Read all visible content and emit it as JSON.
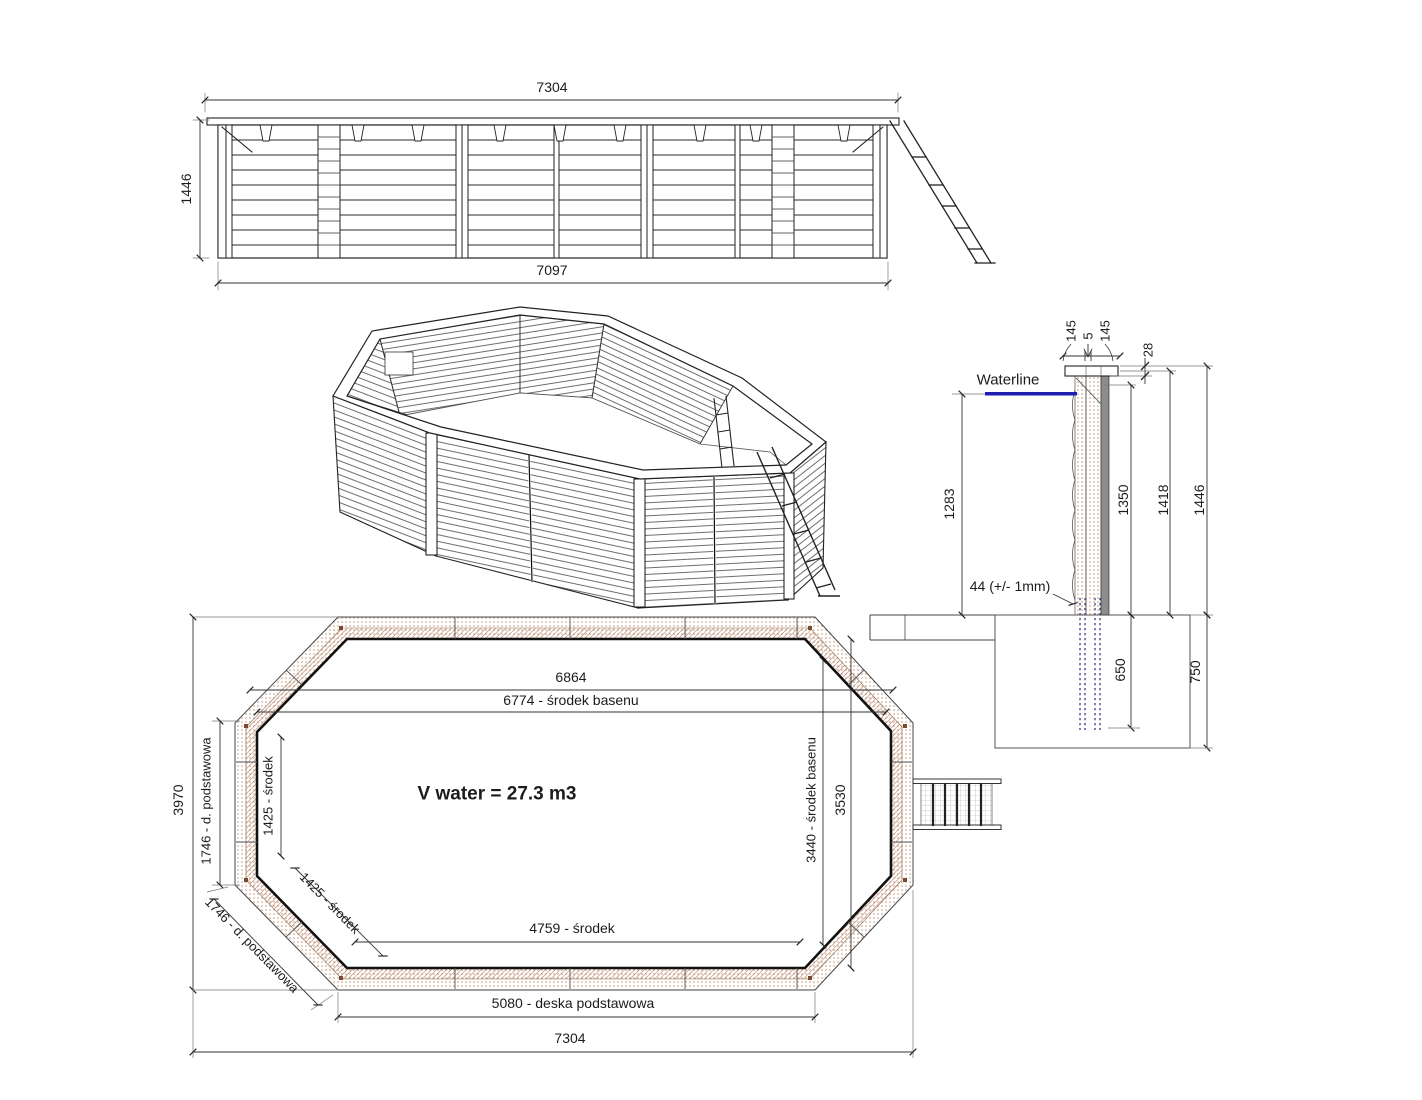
{
  "side_elevation": {
    "dim_top_width": "7304",
    "dim_height": "1446",
    "dim_bottom_width": "7097"
  },
  "cross_section": {
    "dim_cap_left": "145",
    "dim_cap_gap": "5",
    "dim_cap_right": "145",
    "dim_cap_thickness": "28",
    "waterline_label": "Waterline",
    "dim_waterline_height": "1283",
    "dim_wall_plank_height": "1350",
    "dim_wall_mid_height": "1418",
    "dim_wall_total_height": "1446",
    "plank_thickness_note": "44 (+/- 1mm)",
    "dim_post_embed_depth": "650",
    "dim_foundation_depth": "750"
  },
  "plan_view": {
    "dim_inner_width": "6864",
    "dim_center_width": "6774 - środek basenu",
    "dim_total_height": "3970",
    "dim_left_wall": "1746 - d. podstawowa",
    "dim_left_wall_center": "1425 - środek",
    "dim_diagonal_center": "1425 - środek",
    "dim_diagonal_wall": "1746 - d. podstawowa",
    "volume_label": "V water = 27.3 m3",
    "dim_inner_height": "3530",
    "dim_center_height": "3440 - środek basenu",
    "dim_bottom_center": "4759 - środek",
    "dim_base_board": "5080 - deska podstawowa",
    "dim_total_width": "7304"
  },
  "colors": {
    "waterline_blue": "#1d1db0",
    "wall_dot_tan": "#bf9272",
    "wall_hatch_brown": "#b5795a",
    "line_dark": "#222222",
    "foundation_post_blue": "#4a4a8f"
  }
}
